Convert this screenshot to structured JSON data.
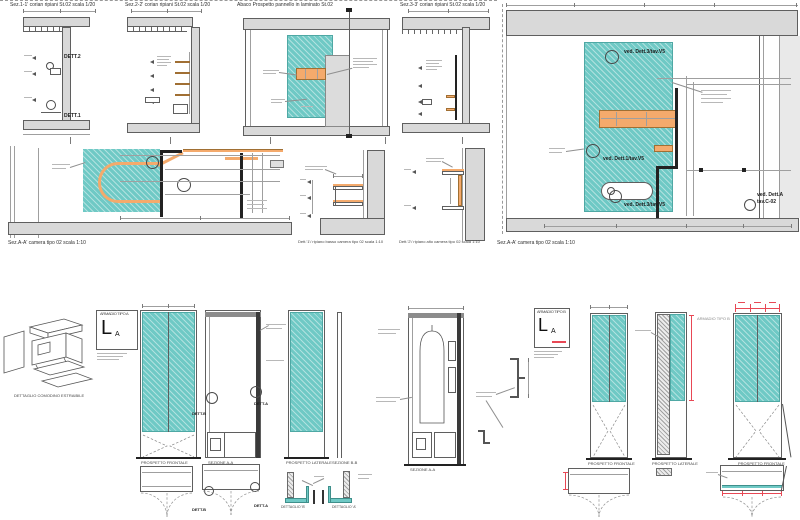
{
  "colors": {
    "teal": "#6FC9C5",
    "orange": "#F4AA6C",
    "wall_gray": "#D9D9D9",
    "hatch_gray": "#ECECEC",
    "accent_red": "#E84855",
    "line": "#555555",
    "background": "#FFFFFF"
  },
  "top": {
    "sez11_title": "Sez.1-1' corian ripiani St.02 scala 1/20",
    "sez22_title": "Sez.2-2' corian ripiani St.02 scala 1/20",
    "abaco_title": "Abaco Prospetto pannello in laminato St.02",
    "sez33_title": "Sez.3-3' corian ripiani St.02 scala 1/20",
    "dett2_label": "DETT.2",
    "dett1_label": "DETT.1",
    "sezAA_caption": "Sez.A-A' camera tipo 02 scala 1:10",
    "callout_dett3": "ved. Dett.3/tav.V5",
    "callout_dett1": "ved. Dett.1/tav.V5",
    "callout_dettA": "ved. Dett.A",
    "callout_tavC02": "tav.C-02"
  },
  "mid": {
    "planAA_caption": "Sez.A-A' camera tipo 02 scala 1:10",
    "dett1_caption": "Dett.'1'/ ripiano basso camera tipo 02 scala 1:10",
    "dett2_caption": "Dett.'2'/ ripiano alto camera tipo 02 scala 1:10"
  },
  "bottom": {
    "comodino_caption": "DETTAGLIO COMODINO ESTRAIBILE",
    "legend_a": {
      "title": "ARMADIO TIPO A",
      "symbol": "L",
      "symbol_sub": "A"
    },
    "legend_b": {
      "title": "ARMADIO TIPO B",
      "symbol": "L",
      "symbol_sub": "A"
    },
    "armadio_tipo_label": "ARMADIO TIPO B",
    "prospetto_frontale": "PROSPETTO FRONTALE",
    "prospetto_laterale": "PROSPETTO LATERALE",
    "sezione_aa": "SEZIONE A-A",
    "sezione_bb": "SEZIONE B-B",
    "dett_b": "DETT.B",
    "dett_a": "DETT.A",
    "dettaglio_b": "DETTAGLIO 'B'",
    "dettaglio_a": "DETTAGLIO 'A'"
  }
}
